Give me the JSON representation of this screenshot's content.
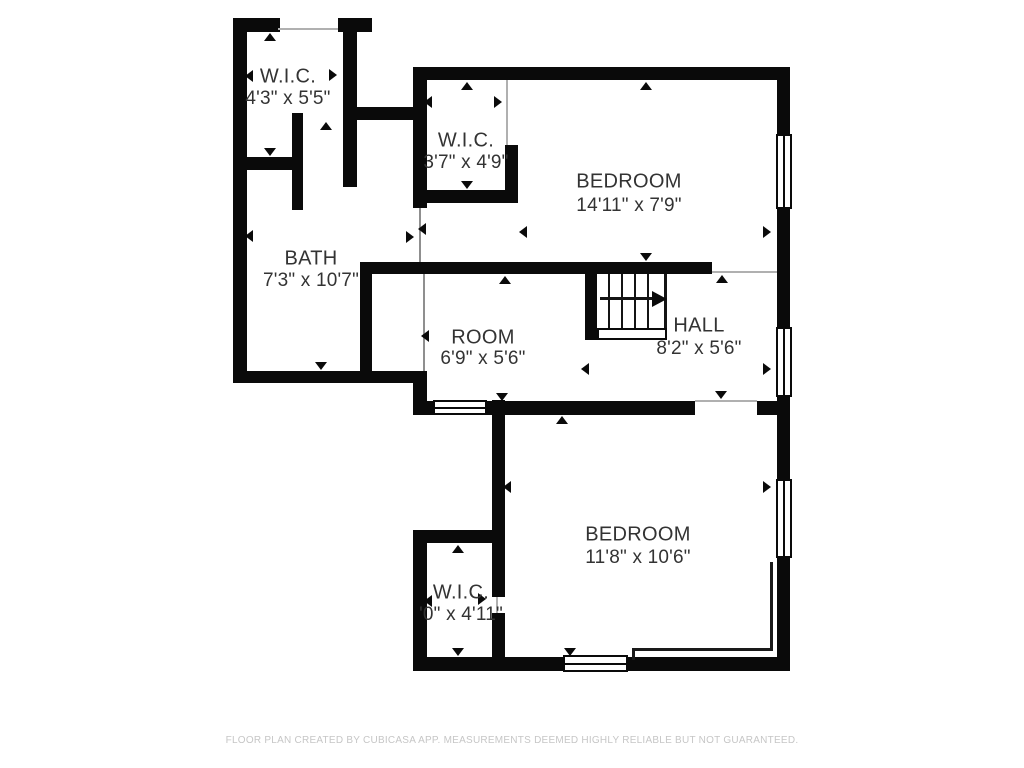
{
  "meta": {
    "canvas_width": 1024,
    "canvas_height": 768,
    "wall_color": "#0a0a0a",
    "text_color": "#333333",
    "footer_color": "#c6c6c6",
    "background_color": "#ffffff"
  },
  "footer": {
    "text": "FLOOR PLAN CREATED BY CUBICASA APP. MEASUREMENTS DEEMED HIGHLY RELIABLE BUT NOT GUARANTEED."
  },
  "plan": {
    "rooms": [
      {
        "id": "wic-top-left",
        "name": "W.I.C.",
        "dims": "4'3\" x 5'5\"",
        "cx": 288,
        "cy": 77,
        "cy2": 99
      },
      {
        "id": "wic-middle",
        "name": "W.I.C.",
        "dims": "3'7\" x 4'9\"",
        "cx": 466,
        "cy": 141,
        "cy2": 163
      },
      {
        "id": "bedroom-top",
        "name": "BEDROOM",
        "dims": "14'11\" x 7'9\"",
        "cx": 629,
        "cy": 182,
        "cy2": 206
      },
      {
        "id": "bath",
        "name": "BATH",
        "dims": "7'3\" x 10'7\"",
        "cx": 311,
        "cy": 259,
        "cy2": 281
      },
      {
        "id": "room",
        "name": "ROOM",
        "dims": "6'9\" x 5'6\"",
        "cx": 483,
        "cy": 338,
        "cy2": 359
      },
      {
        "id": "hall",
        "name": "HALL",
        "dims": "8'2\" x 5'6\"",
        "cx": 699,
        "cy": 326,
        "cy2": 349
      },
      {
        "id": "bedroom-bottom",
        "name": "BEDROOM",
        "dims": "11'8\" x 10'6\"",
        "cx": 638,
        "cy": 535,
        "cy2": 558
      },
      {
        "id": "wic-bottom",
        "name": "W.I.C.",
        "dims": "'0\" x 4'11\"",
        "cx": 461,
        "cy": 593,
        "cy2": 615
      }
    ],
    "walls": [
      [
        "wall-top-wic1-left",
        233,
        18,
        47,
        14
      ],
      [
        "wall-top-wic1-right",
        338,
        18,
        34,
        14
      ],
      [
        "wall-left-outer",
        233,
        18,
        14,
        365
      ],
      [
        "wall-wic1-right",
        343,
        18,
        14,
        169
      ],
      [
        "wall-wic1-bottom",
        247,
        157,
        56,
        13
      ],
      [
        "wall-wic1-stub",
        292,
        113,
        11,
        97
      ],
      [
        "wall-corridor-top",
        355,
        107,
        62,
        13
      ],
      [
        "wall-top-outer",
        413,
        67,
        377,
        13
      ],
      [
        "wall-wic2-left",
        413,
        67,
        14,
        141
      ],
      [
        "wall-wic2-bottom",
        420,
        190,
        98,
        13
      ],
      [
        "wall-wic2-right",
        505,
        145,
        13,
        58
      ],
      [
        "wall-right-outer",
        777,
        67,
        13,
        604
      ],
      [
        "wall-room-hall-top",
        360,
        262,
        352,
        12
      ],
      [
        "wall-nook-left",
        360,
        262,
        12,
        121
      ],
      [
        "wall-bath-bottom",
        233,
        371,
        194,
        12
      ],
      [
        "wall-bath-step",
        413,
        383,
        14,
        32
      ],
      [
        "wall-room-bottom-left",
        413,
        401,
        20,
        14
      ],
      [
        "wall-room-hall-bottom",
        487,
        401,
        208,
        14
      ],
      [
        "wall-hall-bottom-right",
        757,
        401,
        33,
        14
      ],
      [
        "wall-stairs-left",
        585,
        262,
        12,
        78
      ],
      [
        "wall-bed2-left",
        492,
        400,
        13,
        130
      ],
      [
        "wall-wic3-left",
        413,
        530,
        14,
        141
      ],
      [
        "wall-wic3-top",
        413,
        530,
        84,
        13
      ],
      [
        "wall-wic3-right-upper",
        492,
        530,
        13,
        67
      ],
      [
        "wall-wic3-right-lower",
        492,
        613,
        13,
        58
      ],
      [
        "wall-bottom-left",
        413,
        657,
        150,
        14
      ],
      [
        "wall-bottom-right",
        628,
        657,
        162,
        14
      ]
    ],
    "openings": [
      [
        "opening-wic1-top",
        278,
        28,
        60,
        2,
        "#b0b0b0"
      ],
      [
        "opening-bedroom1-entry",
        419,
        208,
        2,
        54,
        "#8f8f8f"
      ],
      [
        "opening-room-nook",
        423,
        274,
        2,
        97,
        "#8f8f8f"
      ],
      [
        "opening-wic2-door",
        506,
        80,
        2,
        65,
        "#b0b0b0"
      ],
      [
        "opening-hall-bedroom1",
        712,
        271,
        65,
        2,
        "#b0b0b0"
      ],
      [
        "opening-hall-bedroom2-door",
        695,
        400,
        62,
        2,
        "#b0b0b0"
      ],
      [
        "opening-wic3-door",
        496,
        597,
        2,
        16,
        "#b0b0b0"
      ]
    ],
    "windows": [
      [
        "window-bedroom1-right",
        "v",
        776,
        134,
        16,
        75
      ],
      [
        "window-hall-right",
        "v",
        776,
        327,
        16,
        70
      ],
      [
        "window-bedroom2-right",
        "v",
        776,
        479,
        16,
        79
      ],
      [
        "window-bedroom2-bottom",
        "h",
        563,
        655,
        65,
        17
      ],
      [
        "window-room-bottom",
        "h",
        433,
        400,
        54,
        15
      ]
    ],
    "arrows": [
      [
        "arrow-wic1-top",
        "up",
        270,
        37
      ],
      [
        "arrow-wic1-left",
        "left",
        253,
        76
      ],
      [
        "arrow-wic1-right",
        "right",
        337,
        75
      ],
      [
        "arrow-wic1-bottom",
        "down",
        270,
        152
      ],
      [
        "arrow-bath-top",
        "up",
        326,
        126
      ],
      [
        "arrow-bath-left",
        "left",
        253,
        236
      ],
      [
        "arrow-bath-bottom",
        "down",
        321,
        366
      ],
      [
        "arrow-wic2-top",
        "up",
        467,
        86
      ],
      [
        "arrow-wic2-left",
        "left",
        432,
        102
      ],
      [
        "arrow-wic2-right",
        "right",
        502,
        102
      ],
      [
        "arrow-wic2-bottom",
        "down",
        467,
        185
      ],
      [
        "arrow-bedroom1-top",
        "up",
        646,
        86
      ],
      [
        "arrow-bedroom1-left",
        "left",
        527,
        232
      ],
      [
        "arrow-bedroom1-right",
        "right",
        771,
        232
      ],
      [
        "arrow-bedroom1-bottom",
        "down",
        646,
        257
      ],
      [
        "arrow-door-pair-right",
        "right",
        414,
        237
      ],
      [
        "arrow-door-pair-left",
        "left",
        426,
        229
      ],
      [
        "arrow-room-top",
        "up",
        505,
        280
      ],
      [
        "arrow-room-left",
        "left",
        429,
        336
      ],
      [
        "arrow-room-bottom",
        "down",
        502,
        397
      ],
      [
        "arrow-hall-top",
        "up",
        722,
        279
      ],
      [
        "arrow-hall-left",
        "left",
        589,
        369
      ],
      [
        "arrow-hall-right",
        "right",
        771,
        369
      ],
      [
        "arrow-hall-bottom",
        "down",
        721,
        395
      ],
      [
        "arrow-bedroom2-top",
        "up",
        562,
        420
      ],
      [
        "arrow-bedroom2-left",
        "left",
        511,
        487
      ],
      [
        "arrow-bedroom2-right",
        "right",
        771,
        487
      ],
      [
        "arrow-bedroom2-bottom",
        "down",
        570,
        652
      ],
      [
        "arrow-wic3-top",
        "up",
        458,
        549
      ],
      [
        "arrow-wic3-left",
        "left",
        432,
        601
      ],
      [
        "arrow-wic3-right",
        "right",
        486,
        599
      ],
      [
        "arrow-wic3-bottom",
        "down",
        458,
        652
      ]
    ],
    "stairs": {
      "tread_lines_x": [
        608,
        621,
        634,
        647
      ],
      "tread_top": 274,
      "tread_height": 56,
      "right_edge": [
        664,
        274,
        3,
        56
      ],
      "landing": [
        597,
        328,
        70,
        12
      ],
      "cap": [
        585,
        328,
        12,
        12
      ],
      "arrow_shaft": [
        600,
        297,
        54,
        3
      ],
      "arrow_head": [
        652,
        291
      ]
    },
    "knee_lines": [
      [
        "knee-vertical",
        770,
        562,
        3,
        89
      ],
      [
        "knee-horizontal",
        632,
        648,
        141,
        3
      ],
      [
        "knee-step",
        632,
        648,
        3,
        12
      ]
    ]
  }
}
